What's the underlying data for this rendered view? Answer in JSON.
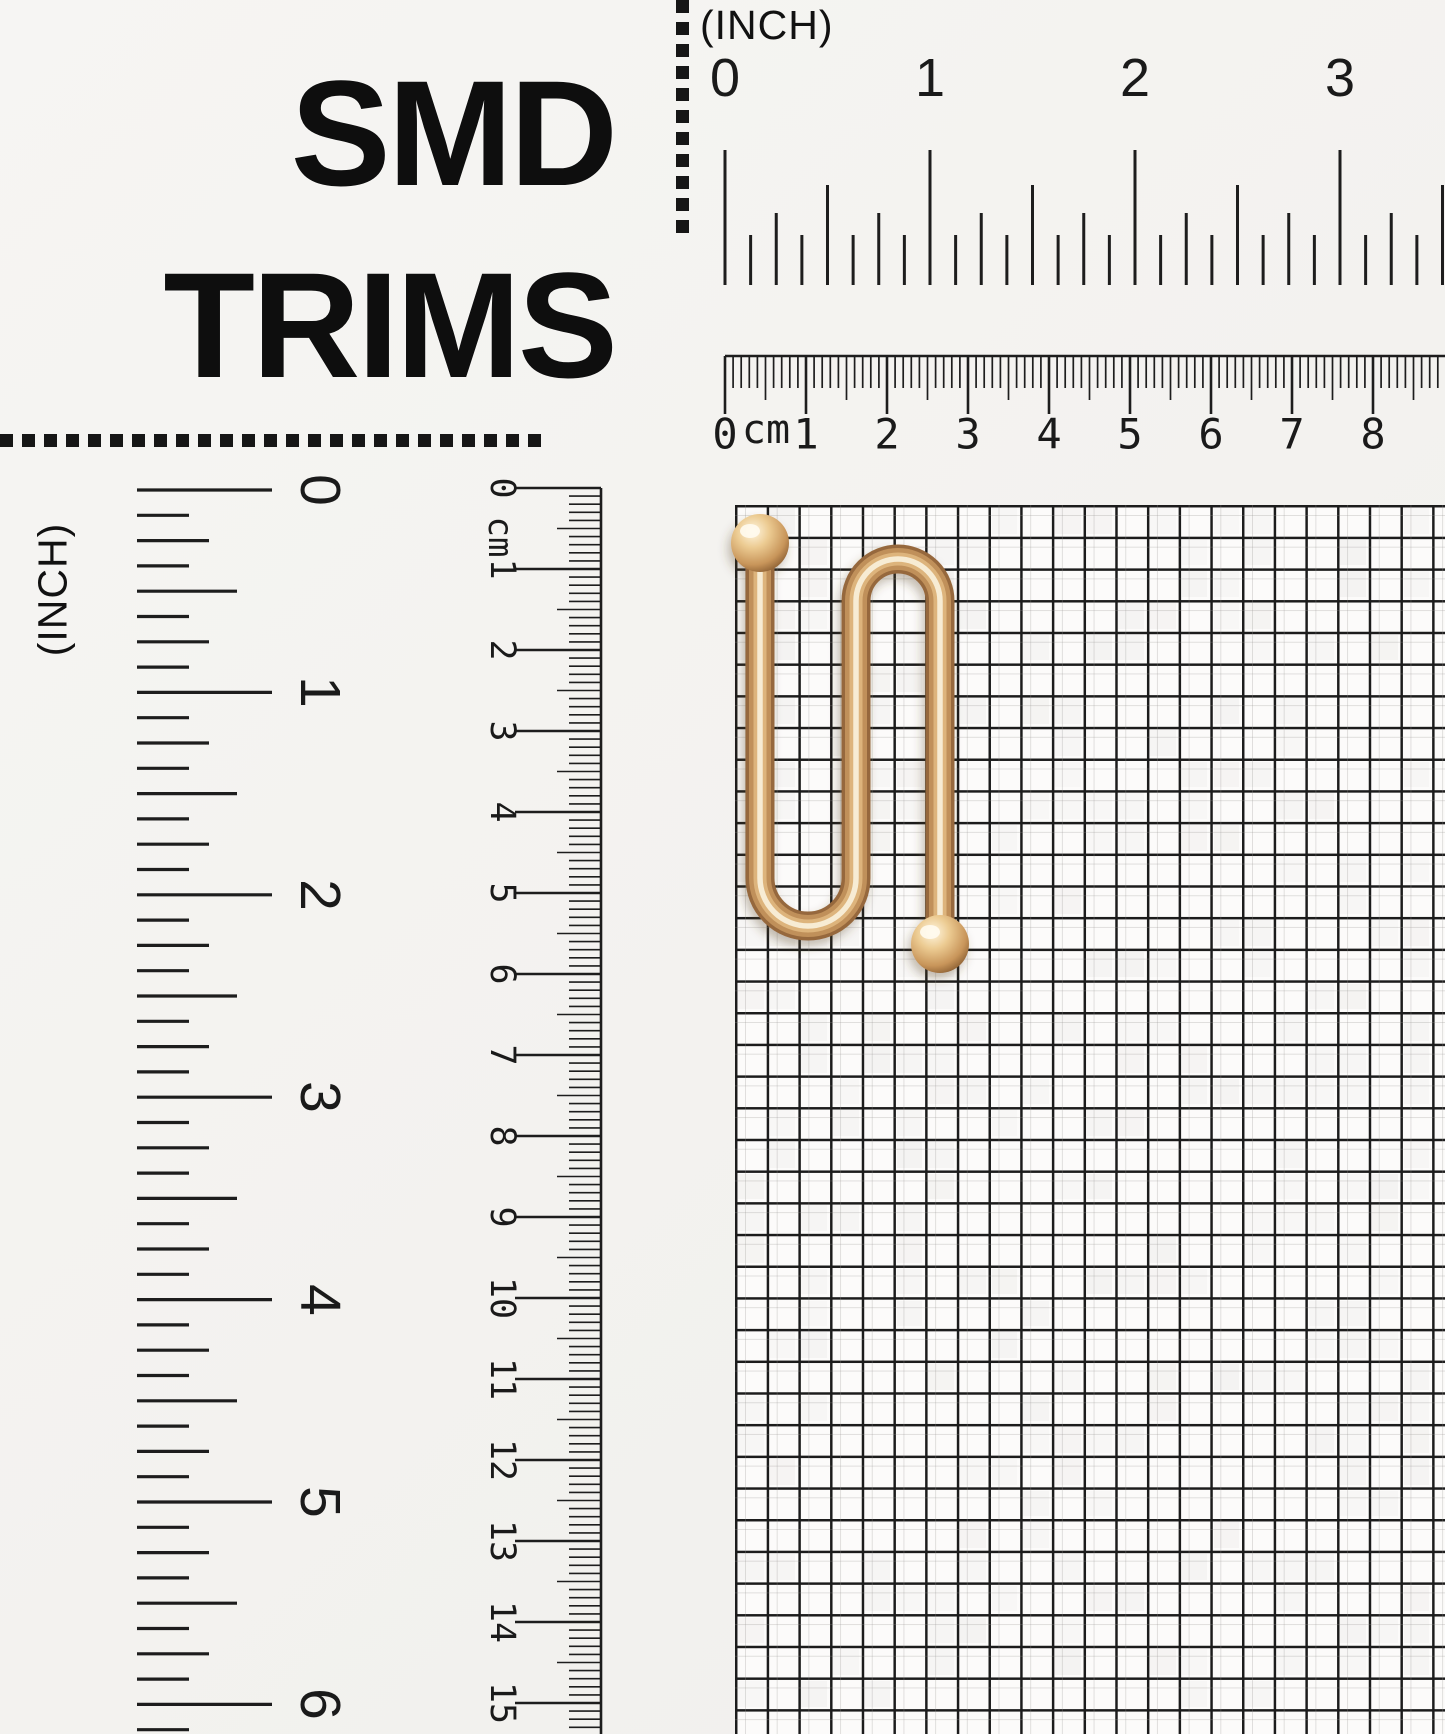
{
  "brand": {
    "line1": "SMD",
    "line2": "TRIMS"
  },
  "top_ruler": {
    "inch_unit_label": "(INCH)",
    "inch_numbers": [
      "0",
      "1",
      "2",
      "3"
    ],
    "cm_numbers": [
      "0",
      "1",
      "2",
      "3",
      "4",
      "5",
      "6",
      "7",
      "8"
    ],
    "cm_unit_label": "cm"
  },
  "left_ruler": {
    "inch_unit_label": "(INCH)",
    "inch_numbers": [
      "0",
      "1",
      "2",
      "3",
      "4",
      "5",
      "6"
    ],
    "cm_numbers": [
      "0",
      "1",
      "2",
      "3",
      "4",
      "5",
      "6",
      "7",
      "8",
      "9",
      "10",
      "11",
      "12",
      "13",
      "14",
      "15"
    ],
    "cm_unit_label": "cm"
  },
  "object": {
    "description": "gold metal serpentine hook trim with ball ends",
    "metal_base_color": "#c0905a",
    "metal_highlight_color": "#f7ecd4",
    "metal_shadow_color": "#96683c",
    "ball_highlight_color": "#fff6e0"
  },
  "colors": {
    "tick_color": "#1d1d1d",
    "grid_line_color": "#1c1c1c",
    "paper_color": "#fcfbfa",
    "background_color": "#f4f3f1",
    "brand_text_color": "#0e0e0e"
  }
}
